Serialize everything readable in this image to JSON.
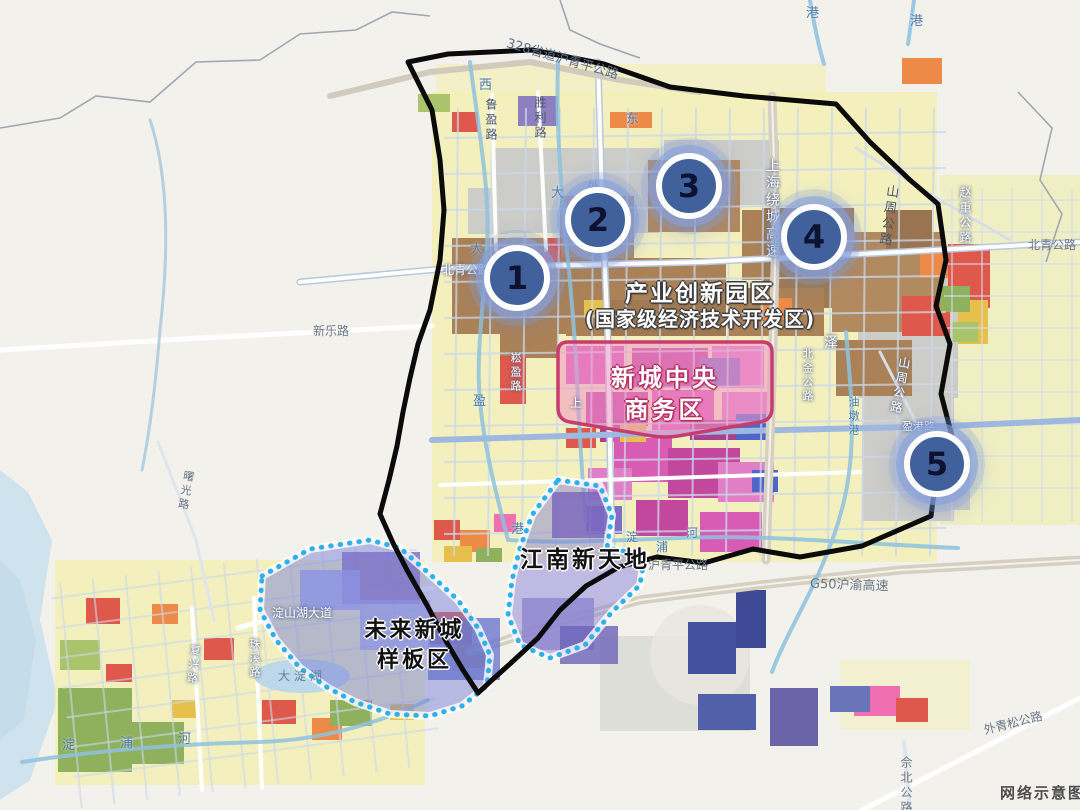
{
  "watermark": "网络示意图",
  "areas": {
    "industrial_park_line1": "产业创新园区",
    "industrial_park_line2": "(国家级经济技术开发区)",
    "cbd_line1": "新城中央",
    "cbd_line2": "商务区",
    "jiangnan": "江南新天地",
    "future_line1": "未来新城",
    "future_line2": "样板区"
  },
  "markers": [
    {
      "id": 1,
      "label": "1"
    },
    {
      "id": 2,
      "label": "2"
    },
    {
      "id": 3,
      "label": "3"
    },
    {
      "id": 4,
      "label": "4"
    },
    {
      "id": 5,
      "label": "5"
    }
  ],
  "roads": {
    "s328": "328省道沪青平公路",
    "shengli": "胜利路",
    "luying": "鲁盈路",
    "waiqingsong_n": "外青松公路",
    "raocheng": "上海绕城高速",
    "shanzhou_ne": "山周公路",
    "zhaozhong": "赵重公路",
    "beiqing_e": "北青公路",
    "beiqing_w": "北青公路",
    "xinle": "新乐路",
    "beijin": "北金公路",
    "shanzhou_e": "山周公路",
    "yinggang": "盈港路",
    "songying": "崧盈路",
    "huqingping": "沪青平公路",
    "g50": "G50沪渝高速",
    "dianshanhu_ave": "淀山湖大道",
    "zhuxi": "珠溪路",
    "fuxing": "复兴路",
    "shuguang": "曙光路",
    "waiqingsong_se": "外青松公路",
    "shebei": "佘北公路"
  },
  "waters": {
    "ze": "泽",
    "xi": "西",
    "dong": "东",
    "da_w": "大",
    "da_e": "大",
    "gang_top1": "港",
    "gang_top2": "港",
    "youdun": "油墩港",
    "ying": "盈",
    "gang_mid": "港",
    "shang": "上",
    "dian_mid": "淀",
    "pu_mid": "浦",
    "he_mid": "河",
    "dian_sw": "淀",
    "pu_sw": "浦",
    "he_sw": "河",
    "dadianhu": "大淀湖"
  },
  "colors": {
    "boundary": "#000000",
    "dotted_boundary": "#2fb0e8",
    "marker_disc": "#41619c",
    "marker_ring": "#ffffff",
    "marker_halo": "#8fa8dc",
    "cbd_border": "#c73c6e",
    "cbd_fill": "#f291c4",
    "overlay_purple": "#7b82d4"
  }
}
